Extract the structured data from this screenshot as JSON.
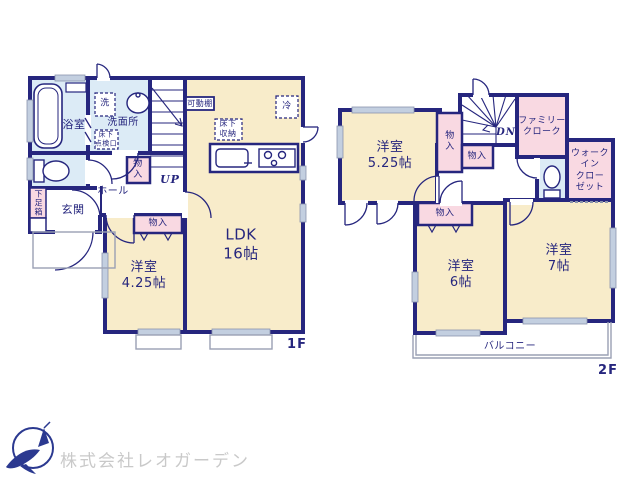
{
  "document_type": "間取り図",
  "colors": {
    "wall_navy": "#26267e",
    "room_cream": "#f8ecca",
    "closet_pink": "#f9d9e2",
    "wet_area_blue": "#dcebf6",
    "window_gray": "#c3cfe0",
    "outline_gray": "#9aa0b4",
    "logo_navy": "#2b3990",
    "logo_text_gray": "#c9c9c9"
  },
  "floor1": {
    "floor_label": "1F",
    "rooms": {
      "ldk": "LDK\n16帖",
      "bedroom": "洋室\n4.25帖",
      "bath": "浴室",
      "washroom": "洗面所",
      "entrance": "玄関",
      "hall": "ホール"
    },
    "features": {
      "laundry": "洗",
      "fridge": "冷",
      "movable_shelf": "可動棚",
      "underfloor_storage": "床下\n収納",
      "underfloor_hatch": "床下\n点検口",
      "stairs_up": "UP",
      "closet_hall": "物\n入",
      "closet_bedroom": "物入",
      "shoe_box": "下足箱"
    }
  },
  "floor2": {
    "floor_label": "2F",
    "rooms": {
      "bedroom_525": "洋室\n5.25帖",
      "bedroom_6": "洋室\n6帖",
      "bedroom_7": "洋室\n7帖",
      "family_cloak": "ファミリー\nクローク",
      "walk_in_closet": "ウォーク\nイン\nクロー\nゼット",
      "balcony": "バルコニー"
    },
    "features": {
      "stairs_down": "DN",
      "closet_a": "物\n入",
      "closet_b": "物入",
      "closet_bedroom6": "物入"
    }
  },
  "logo": {
    "company_name": "株式会社レオガーデン"
  }
}
